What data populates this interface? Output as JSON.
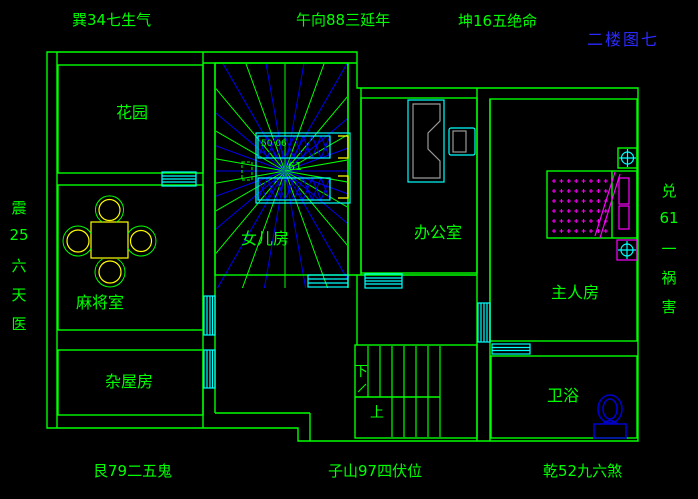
{
  "colors": {
    "background": "#000000",
    "line_green": "#00ff00",
    "window_cyan": "#00ffff",
    "ray_blue": "#0000ee",
    "furniture_yellow": "#ffff00",
    "furniture_magenta": "#ff00ff",
    "desk_gray": "#9a9a9a",
    "title_blue": "#2a2aff",
    "toilet_blue": "#0000cd"
  },
  "annotations": {
    "top_left": "巽34七生气",
    "top_center": "午向88三延年",
    "top_right": "坤16五绝命",
    "title": "二楼图七",
    "left_vertical": [
      "震",
      "25",
      "六",
      "天",
      "医"
    ],
    "right_vertical": [
      "兑",
      "61",
      "一",
      "祸",
      "害"
    ],
    "bottom_left": "艮79二五鬼",
    "bottom_center": "子山97四伏位",
    "bottom_right": "乾52九六煞"
  },
  "rooms": {
    "garden": "花园",
    "mahjong": "麻将室",
    "storage": "杂屋房",
    "daughter": "女儿房",
    "office": "办公室",
    "master": "主人房",
    "bath": "卫浴"
  },
  "stairs": {
    "down": "下",
    "up": "上"
  },
  "bed_numbers": {
    "top": "50 06",
    "mid": "61"
  }
}
